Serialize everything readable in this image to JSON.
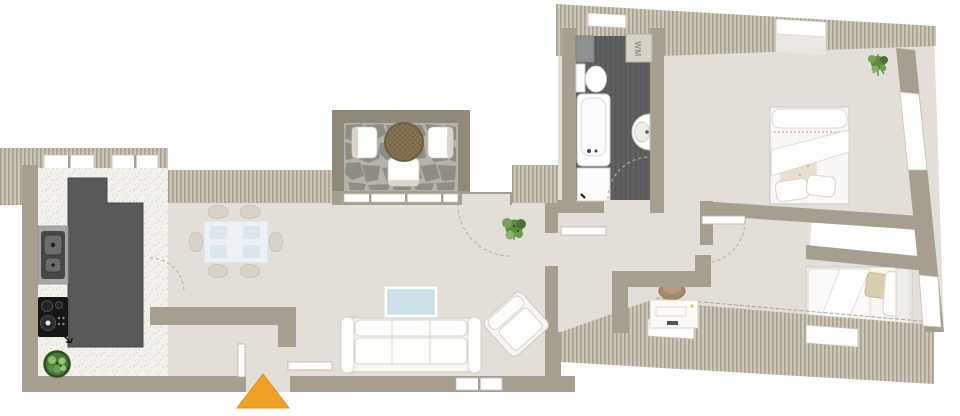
{
  "labels": {
    "washing_machine_label": "WM"
  },
  "colors": {
    "wall": "#a69f8f",
    "wallDark": "#8f897a",
    "hatchBase": "#cdc7b8",
    "hatchStripe": "#a8a192",
    "floor": "#e4ded8",
    "kitchenFloor": "#f3f1ec",
    "kitchenSpeckle": "#d8d3ca",
    "bathFloor": "#5f5f5f",
    "bathFloorStripe": "#565656",
    "counter": "#595959",
    "counterEdge": "#4b4b4b",
    "appliance": "#161616",
    "sinkSteel": "#a7a7a5",
    "stone": "#8d8c85",
    "stoneJoint": "#b4b2a9",
    "wicker": "#8a7757",
    "wickerLine": "#6f5d41",
    "whiteFurniture": "#f7f6f3",
    "furnitureStroke": "#ccc8c0",
    "tvScreen": "#cfe2eb",
    "entranceArrow": "#f0a125",
    "entranceArrowEdge": "#d98f1d",
    "plantDark": "#3f6030",
    "plantMid": "#6b9d4e",
    "plantLight": "#8fbc6d",
    "pillowBeige": "#d8cdb0",
    "bedTrimPink": "#e8a9b6",
    "chairGray": "#d7d3c9",
    "deskChairBrown": "#a28a69"
  },
  "rooms": [
    "kitchen",
    "dining-area",
    "living-room",
    "terrace",
    "hallway",
    "bathroom",
    "bedroom-1",
    "bedroom-2"
  ],
  "fixtures": [
    "kitchen-counter",
    "kitchen-sink",
    "cooktop",
    "kitchen-plant",
    "dining-table",
    "dining-chairs",
    "sofa",
    "armchair",
    "tv-lowboard",
    "living-room-plant",
    "terrace-table",
    "terrace-chairs",
    "bathtub",
    "toilet",
    "washbasin",
    "shower-tray",
    "washing-machine",
    "double-bed",
    "single-bed",
    "desk",
    "desk-chair",
    "bedroom-plant",
    "entrance-arrow"
  ],
  "entrance": {
    "marker": "triangle-up"
  }
}
